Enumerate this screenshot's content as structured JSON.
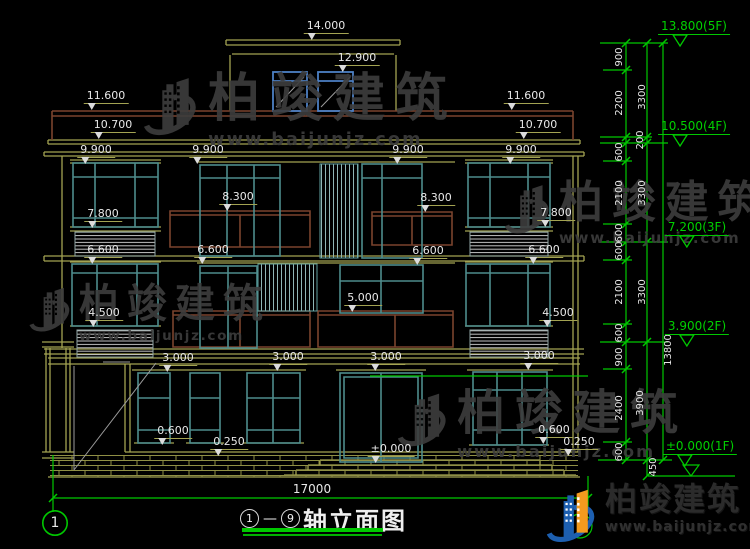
{
  "title_block": {
    "axis_start": "1",
    "axis_end": "9",
    "joiner": "—",
    "title": "轴立面图"
  },
  "axes": {
    "left_label": "1"
  },
  "brand": {
    "title": "柏竣建筑",
    "url": "www.baijunjz.com"
  },
  "watermark": {
    "title": "柏竣建筑",
    "url": "www.baijunjz.com",
    "instances": [
      {
        "x": 142,
        "y": 72,
        "size": 52
      },
      {
        "x": 503,
        "y": 180,
        "size": 44
      },
      {
        "x": 28,
        "y": 283,
        "size": 40
      },
      {
        "x": 396,
        "y": 388,
        "size": 48
      }
    ]
  },
  "colors": {
    "background": "#000000",
    "dimension_line": "#a3a352",
    "dimension_text": "#e8e8e8",
    "axis_green": "#00c800",
    "window_teal": "#4e8c8c",
    "railing_brown": "#7a432e",
    "penthouse_blue": "#4d80c4",
    "watermark_gray": "#3d3d3d"
  },
  "annotations": [
    {
      "t": "14.000",
      "x": 326,
      "y": 20,
      "k": "d"
    },
    {
      "t": "12.900",
      "x": 357,
      "y": 52,
      "k": "d"
    },
    {
      "t": "11.600",
      "x": 106,
      "y": 90,
      "k": "d"
    },
    {
      "t": "11.600",
      "x": 526,
      "y": 90,
      "k": "d"
    },
    {
      "t": "10.700",
      "x": 113,
      "y": 119,
      "k": "d"
    },
    {
      "t": "10.700",
      "x": 538,
      "y": 119,
      "k": "d"
    },
    {
      "t": "9.900",
      "x": 96,
      "y": 144,
      "k": "d"
    },
    {
      "t": "9.900",
      "x": 208,
      "y": 144,
      "k": "d"
    },
    {
      "t": "9.900",
      "x": 408,
      "y": 144,
      "k": "d"
    },
    {
      "t": "9.900",
      "x": 521,
      "y": 144,
      "k": "d"
    },
    {
      "t": "8.300",
      "x": 238,
      "y": 191,
      "k": "d"
    },
    {
      "t": "8.300",
      "x": 436,
      "y": 192,
      "k": "d"
    },
    {
      "t": "7.800",
      "x": 103,
      "y": 208,
      "k": "d"
    },
    {
      "t": "7.800",
      "x": 556,
      "y": 207,
      "k": "d"
    },
    {
      "t": "6.600",
      "x": 103,
      "y": 244,
      "k": "d"
    },
    {
      "t": "6.600",
      "x": 213,
      "y": 244,
      "k": "d"
    },
    {
      "t": "6.600",
      "x": 428,
      "y": 245,
      "k": "d"
    },
    {
      "t": "6.600",
      "x": 544,
      "y": 244,
      "k": "d"
    },
    {
      "t": "5.000",
      "x": 363,
      "y": 292,
      "k": "d"
    },
    {
      "t": "4.500",
      "x": 104,
      "y": 307,
      "k": "d"
    },
    {
      "t": "4.500",
      "x": 558,
      "y": 307,
      "k": "d"
    },
    {
      "t": "3.000",
      "x": 178,
      "y": 352,
      "k": "d"
    },
    {
      "t": "3.000",
      "x": 288,
      "y": 351,
      "k": "d"
    },
    {
      "t": "3.000",
      "x": 386,
      "y": 351,
      "k": "d"
    },
    {
      "t": "3.000",
      "x": 539,
      "y": 350,
      "k": "d"
    },
    {
      "t": "0.600",
      "x": 173,
      "y": 425,
      "k": "d"
    },
    {
      "t": "0.600",
      "x": 554,
      "y": 424,
      "k": "d"
    },
    {
      "t": "0.250",
      "x": 229,
      "y": 436,
      "k": "d"
    },
    {
      "t": "0.250",
      "x": 579,
      "y": 436,
      "k": "d"
    },
    {
      "t": "±0.000",
      "x": 391,
      "y": 443,
      "k": "d"
    },
    {
      "t": "17000",
      "x": 312,
      "y": 483,
      "k": "p"
    },
    {
      "t": "900",
      "x": 620,
      "y": 57,
      "k": "r"
    },
    {
      "t": "2200",
      "x": 620,
      "y": 103,
      "k": "r"
    },
    {
      "t": "600",
      "x": 620,
      "y": 152,
      "k": "r"
    },
    {
      "t": "2100",
      "x": 620,
      "y": 193,
      "k": "r"
    },
    {
      "t": "600",
      "x": 620,
      "y": 233,
      "k": "r"
    },
    {
      "t": "600",
      "x": 620,
      "y": 251,
      "k": "r"
    },
    {
      "t": "2100",
      "x": 620,
      "y": 292,
      "k": "r"
    },
    {
      "t": "600",
      "x": 620,
      "y": 333,
      "k": "r"
    },
    {
      "t": "900",
      "x": 620,
      "y": 357,
      "k": "r"
    },
    {
      "t": "2400",
      "x": 620,
      "y": 408,
      "k": "r"
    },
    {
      "t": "600",
      "x": 620,
      "y": 452,
      "k": "r"
    },
    {
      "t": "3300",
      "x": 643,
      "y": 97,
      "k": "r"
    },
    {
      "t": "200",
      "x": 641,
      "y": 140,
      "k": "r"
    },
    {
      "t": "3300",
      "x": 643,
      "y": 193,
      "k": "r"
    },
    {
      "t": "3300",
      "x": 643,
      "y": 292,
      "k": "r"
    },
    {
      "t": "3900",
      "x": 641,
      "y": 403,
      "k": "r"
    },
    {
      "t": "450",
      "x": 654,
      "y": 467,
      "k": "r"
    },
    {
      "t": "13800",
      "x": 669,
      "y": 350,
      "k": "r"
    },
    {
      "t": "13.800(5F)",
      "x": 694,
      "y": 20,
      "k": "g"
    },
    {
      "t": "10.500(4F)",
      "x": 694,
      "y": 120,
      "k": "g"
    },
    {
      "t": "7.200(3F)",
      "x": 697,
      "y": 221,
      "k": "g"
    },
    {
      "t": "3.900(2F)",
      "x": 697,
      "y": 320,
      "k": "g"
    },
    {
      "t": "±0.000(1F)",
      "x": 700,
      "y": 440,
      "k": "g"
    }
  ]
}
